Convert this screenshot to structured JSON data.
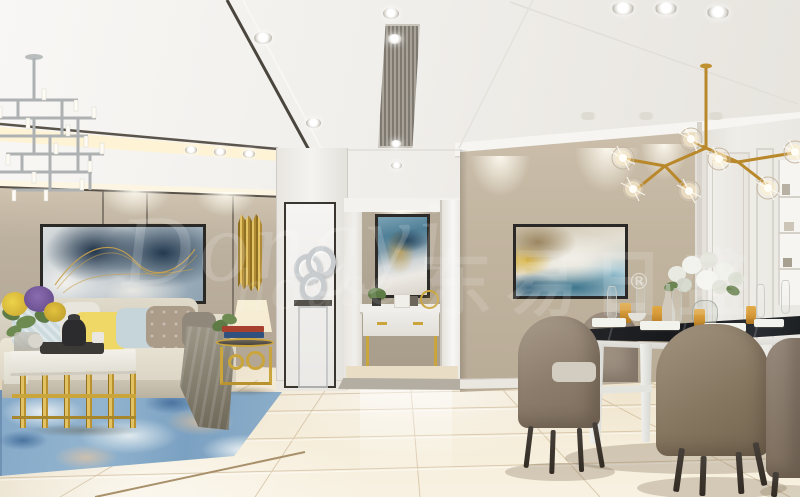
{
  "watermark": {
    "script": "Dongyi",
    "script2": "house",
    "cjk": "东易日盛",
    "reg": "®"
  },
  "colors": {
    "ceiling1": "#f8f7f5",
    "ceiling2": "#e7e4de",
    "trimDark": "#575148",
    "coveGlow": "#fff3d2",
    "cornice": "#f6f5f2",
    "wallPanel1": "#cfc3b0",
    "wallPanel2": "#b3a694",
    "seam": "#6e6659",
    "drape": "#b2a99c",
    "nicheWhite": "#f4f3f0",
    "frameDark": "#3a362f",
    "silver": "#c9ccce",
    "hallWall1": "#b6aa98",
    "hallWall2": "#a89c8a",
    "jambWhite": "#f1efeb",
    "diningWall1": "#cbbeaa",
    "diningWall2": "#b9ac97",
    "panelWhite": "#efede8",
    "panelShadow": "#d8d4cc",
    "floor1": "#e6d9c0",
    "floor2": "#f6eedb",
    "tileLine": "#c3ac87",
    "goldSeam": "#a8906a",
    "threshold": "#b3ada2",
    "rug1": "#85a9c8",
    "rug2": "#4a739f",
    "rugLight": "#e9eff3",
    "rugTan": "#c8b9a5",
    "sofa1": "#ebe5d6",
    "skirt": "#ccc5b4",
    "pillowBlue": "#ccdade",
    "pillowYellow": "#f0d867",
    "pillowTaupe": "#ab9c8a",
    "pillowGray": "#90897b",
    "throw1": "#9d9788",
    "throw2": "#6e6859",
    "gold": "#caa53c",
    "goldDeep": "#8f6f22",
    "goldLight": "#e3c264",
    "marbleTop": "#f3f1ea",
    "blackTray": "#3b3a37",
    "artNavy": "#243a50",
    "artSteel": "#b9c4cb",
    "artGold": "#c9a24c",
    "hallArtBlue": "#4f7f97",
    "hallArtNavy": "#2a4a63",
    "dinArtTan": "#9b8660",
    "dinArtYellow": "#d8b23e",
    "dinArtTeal": "#3e768e",
    "dinArtNavy": "#27506b",
    "dinArtSky": "#9ec7d6",
    "lampShade": "#f5ecd2",
    "plant": "#5e7a45",
    "chair1": "#a2937f",
    "chair2": "#73644f",
    "chairLeg": "#332c24",
    "seatPad": "#d3ccc0",
    "tableBlack": "#17191c",
    "tableWhite": "#eeeeea",
    "amber": "#d99a35",
    "glassEdge": "#c6c8c2",
    "chandelierSilver": "#b0b3b4",
    "chandelierGold": "#b8882a"
  }
}
